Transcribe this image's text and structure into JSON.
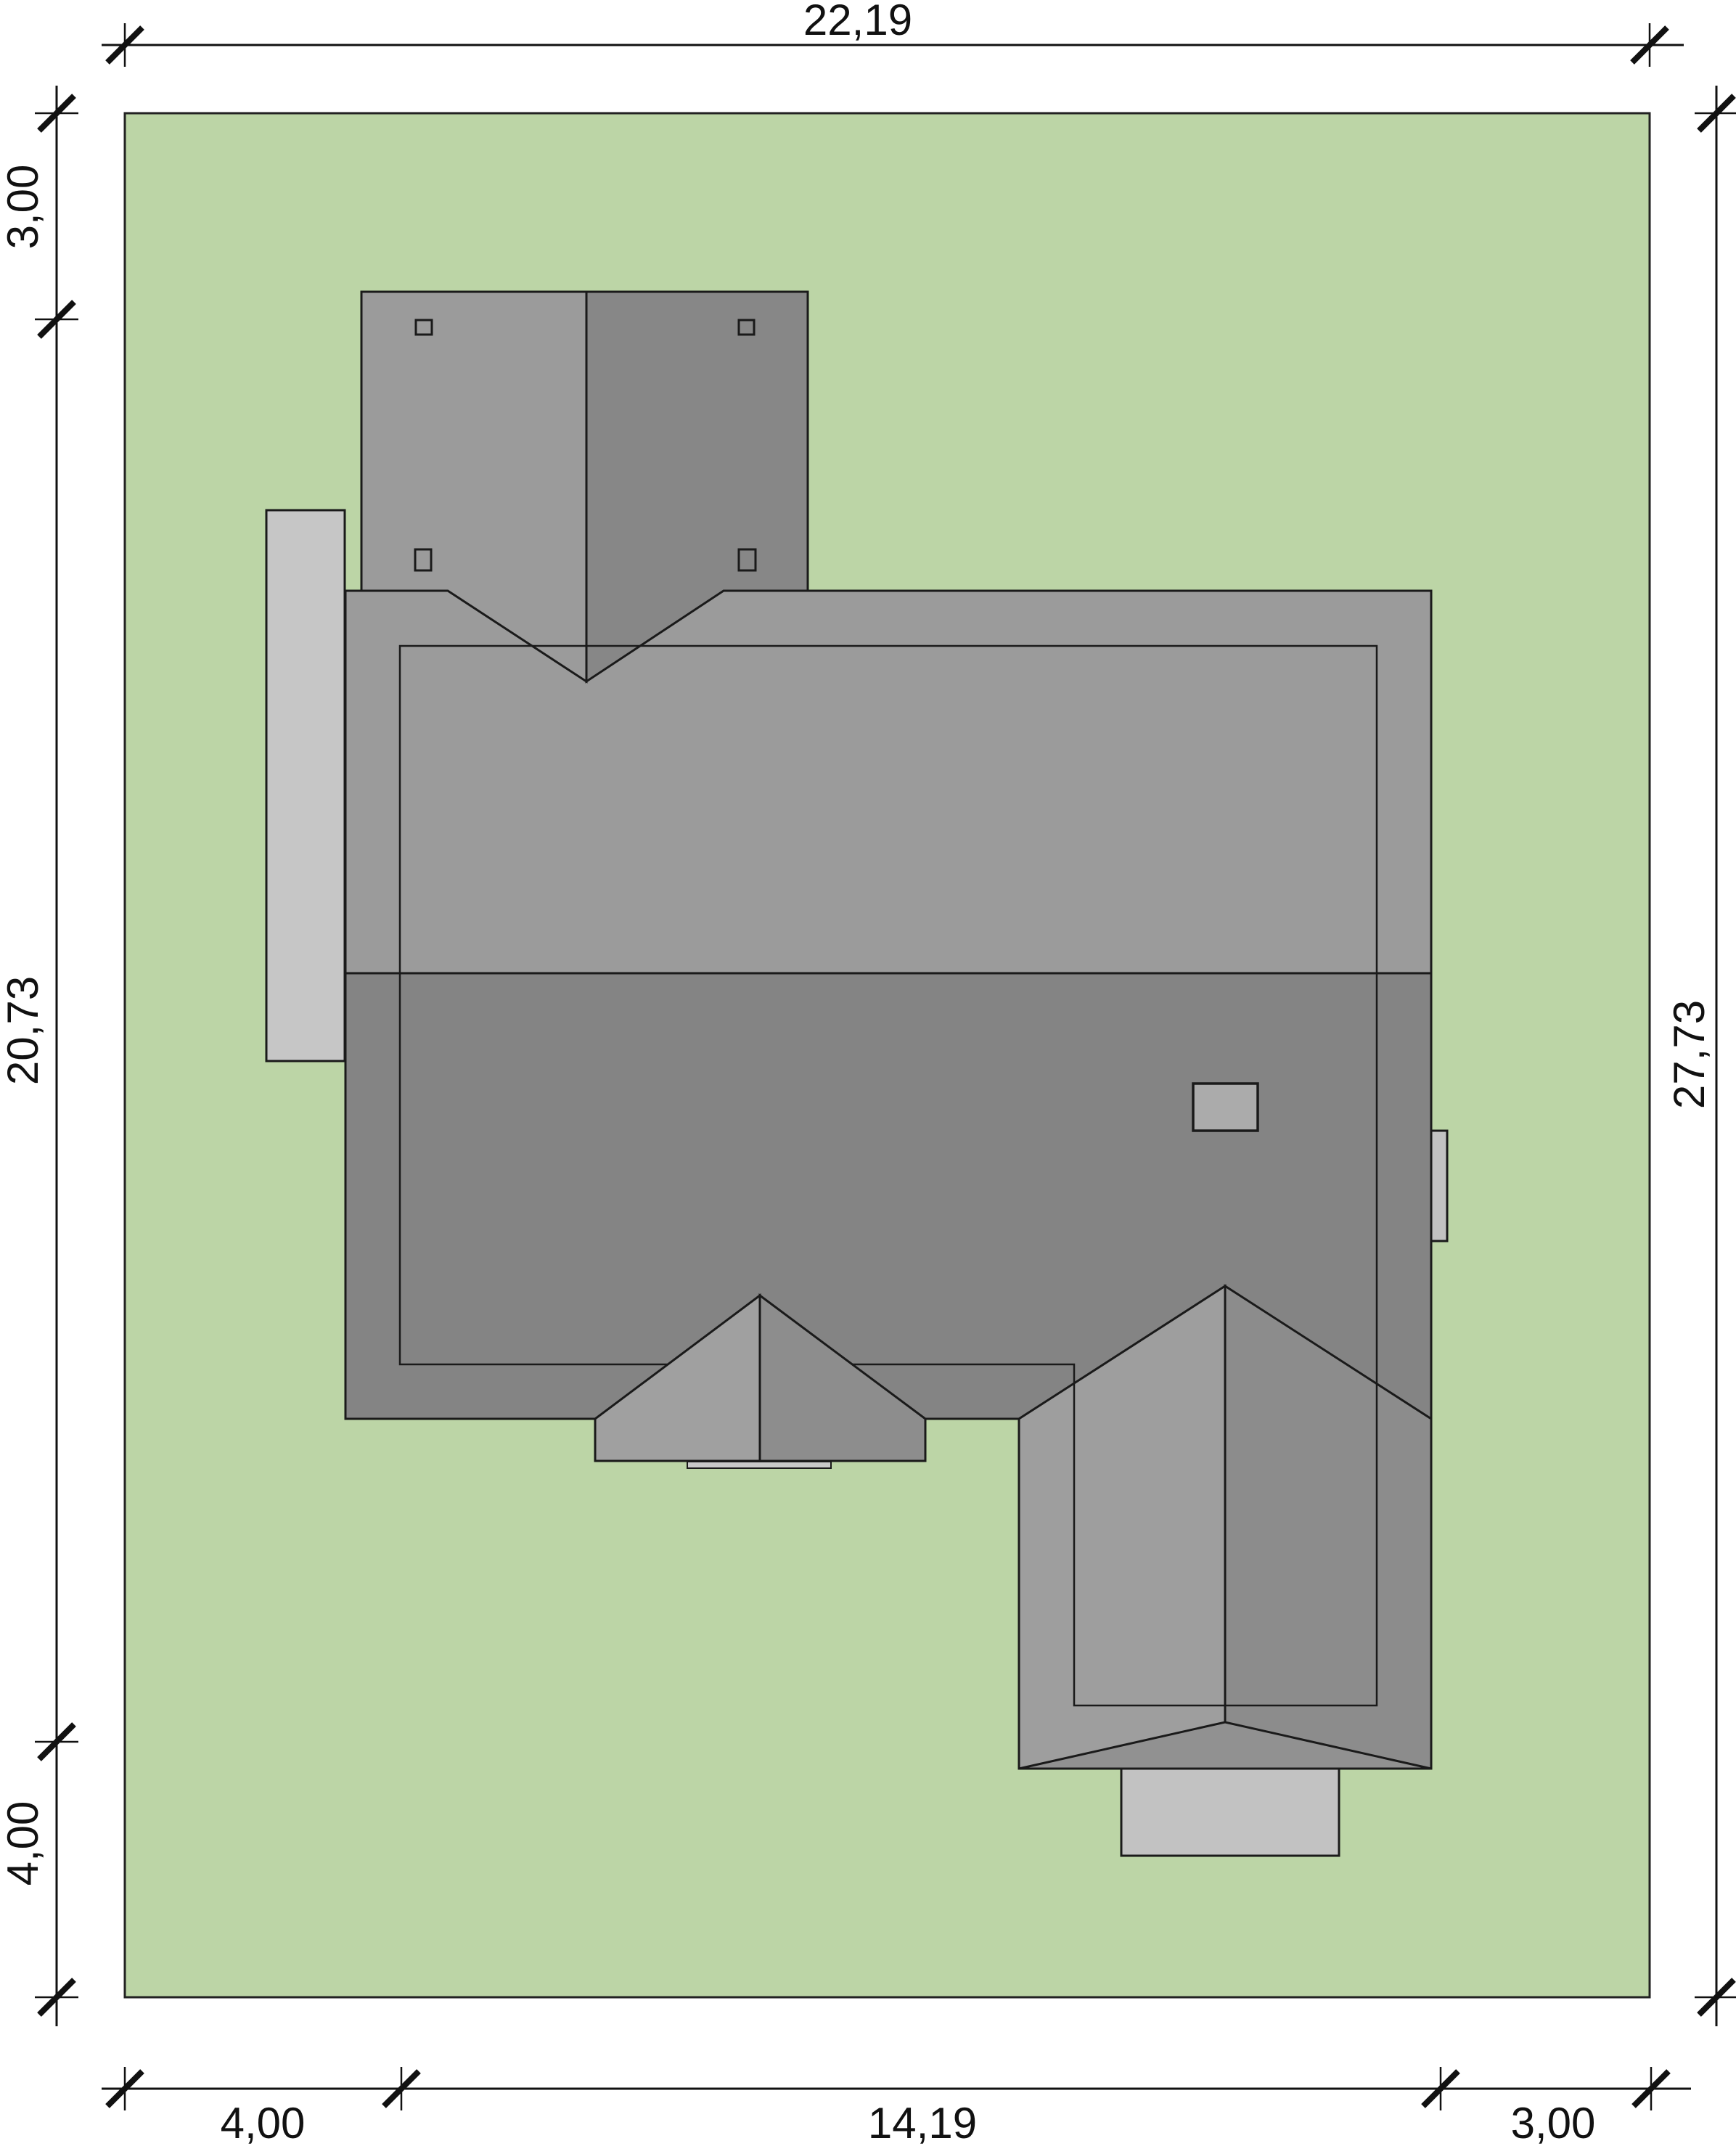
{
  "drawing": {
    "kind": "site-plan roof view",
    "dimensions": {
      "top": {
        "total": "22,19"
      },
      "left": {
        "top": "3,00",
        "middle": "20,73",
        "bottom": "4,00"
      },
      "right": {
        "total": "27,73"
      },
      "bottom": {
        "left": "4,00",
        "middle": "14,19",
        "right": "3,00"
      }
    },
    "colors": {
      "plot_green": "#bcd5a6",
      "terrace_gray": "#c6c6c6",
      "roof_upper": "#9b9b9b",
      "roof_lower": "#848484",
      "gable_left": "#9b9b9b",
      "gable_right": "#878787",
      "porch_left": "#a0a0a0",
      "porch_right": "#8d8d8d",
      "wing_left": "#9e9e9e",
      "wing_right": "#8c8c8c",
      "wing_hip": "#919191",
      "chimney_fill": "#ababab",
      "steps_gray": "#c2c2c2",
      "line": "#1a1a1a"
    }
  }
}
